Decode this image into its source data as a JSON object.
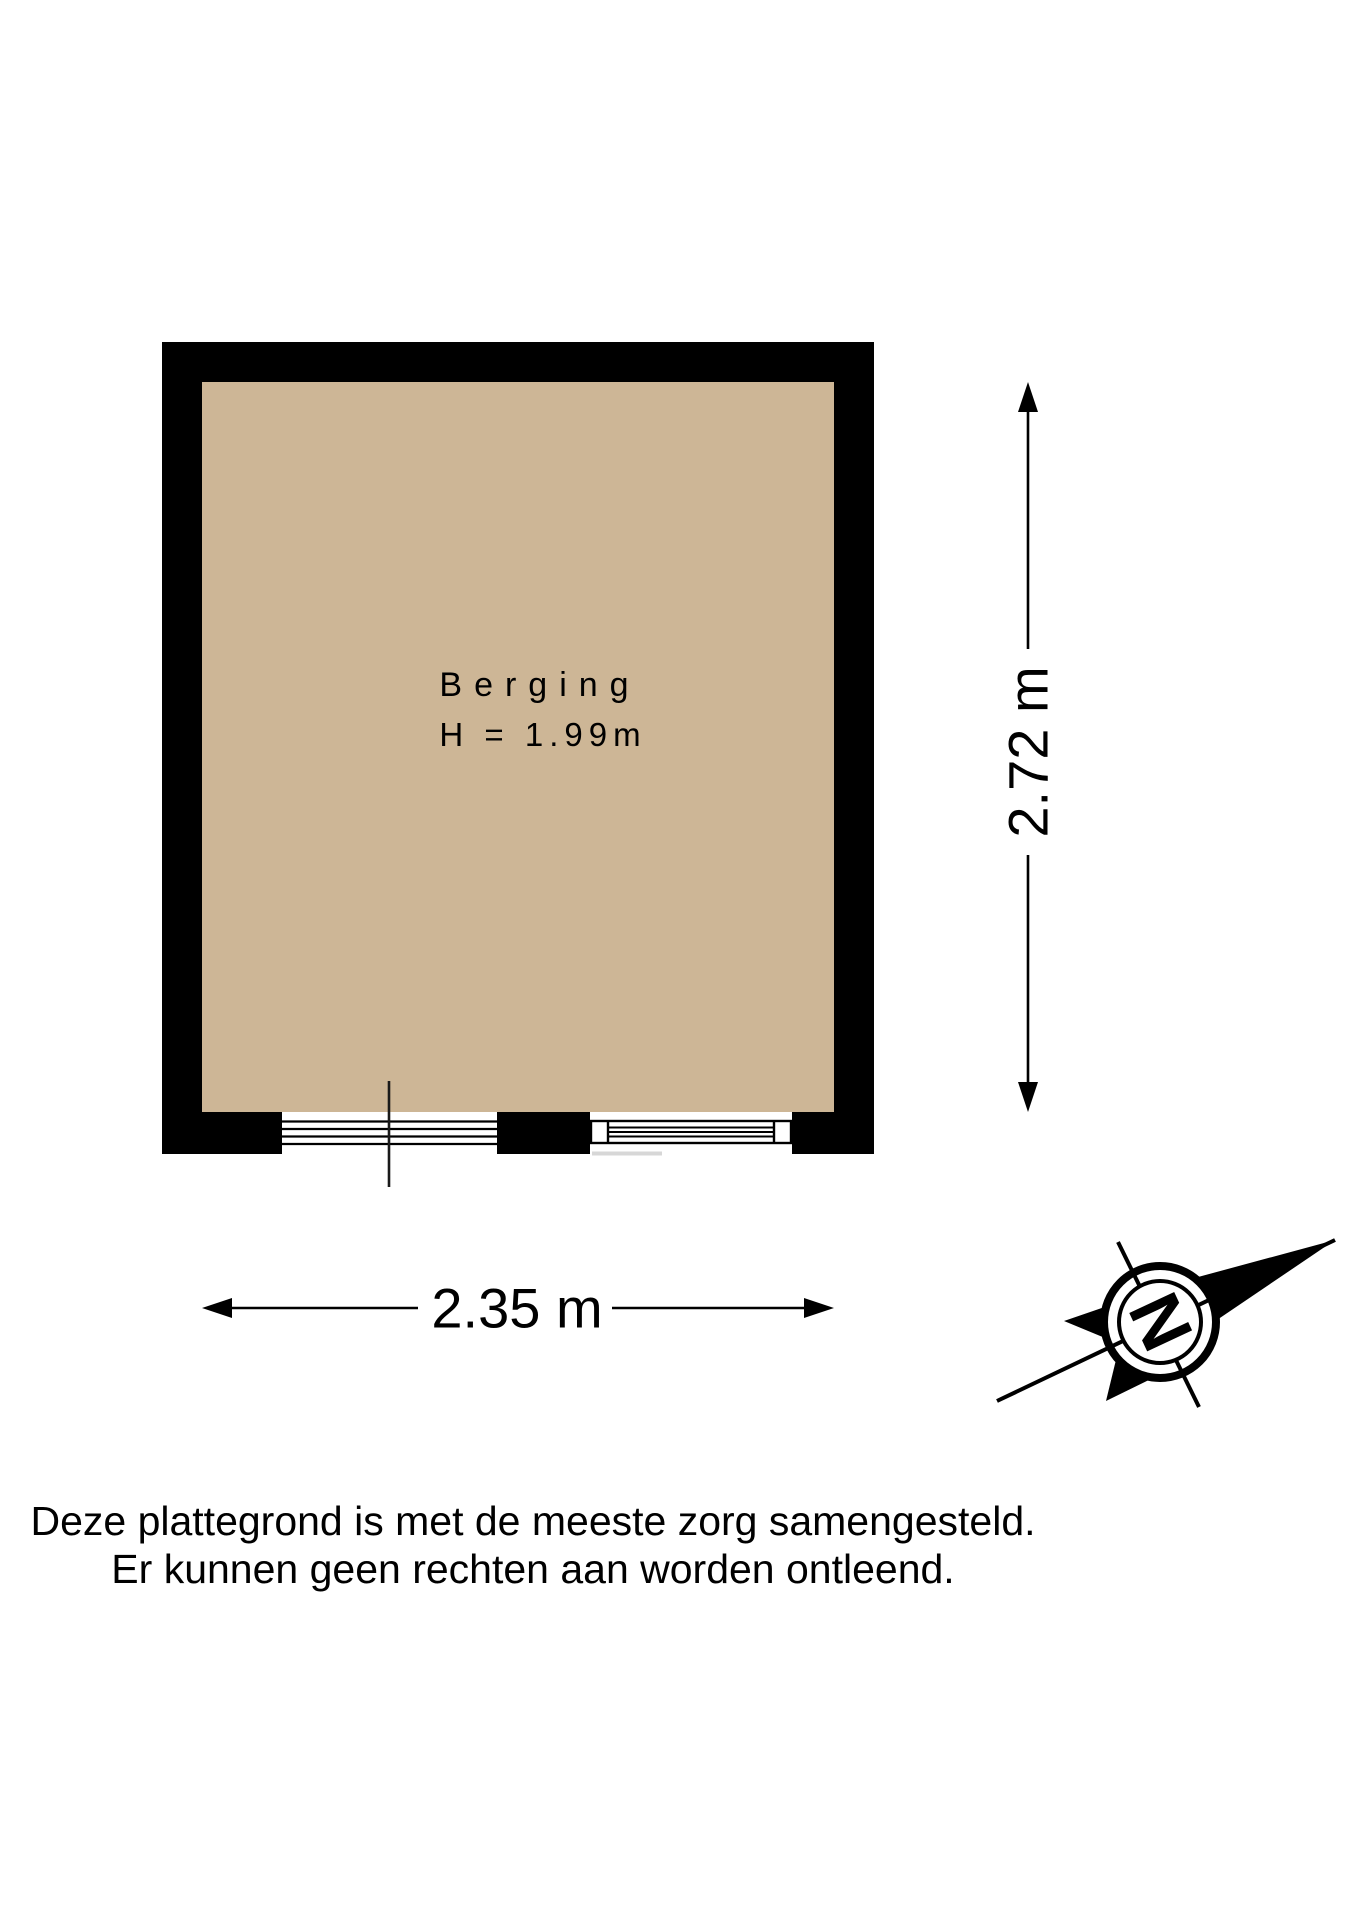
{
  "room": {
    "name": "Berging",
    "ceiling_height_label": "H = 1.99m"
  },
  "dimensions": {
    "width_label": "2.35 m",
    "height_label": "2.72 m"
  },
  "compass": {
    "north_label": "N"
  },
  "disclaimer": {
    "line1": "Deze plattegrond is met de meeste zorg samengesteld.",
    "line2": "Er kunnen geen rechten aan worden ontleend."
  },
  "colors": {
    "wall": "#000000",
    "floor": "#CDB696",
    "background": "#FFFFFF",
    "shadow": "#D7D7D7"
  }
}
